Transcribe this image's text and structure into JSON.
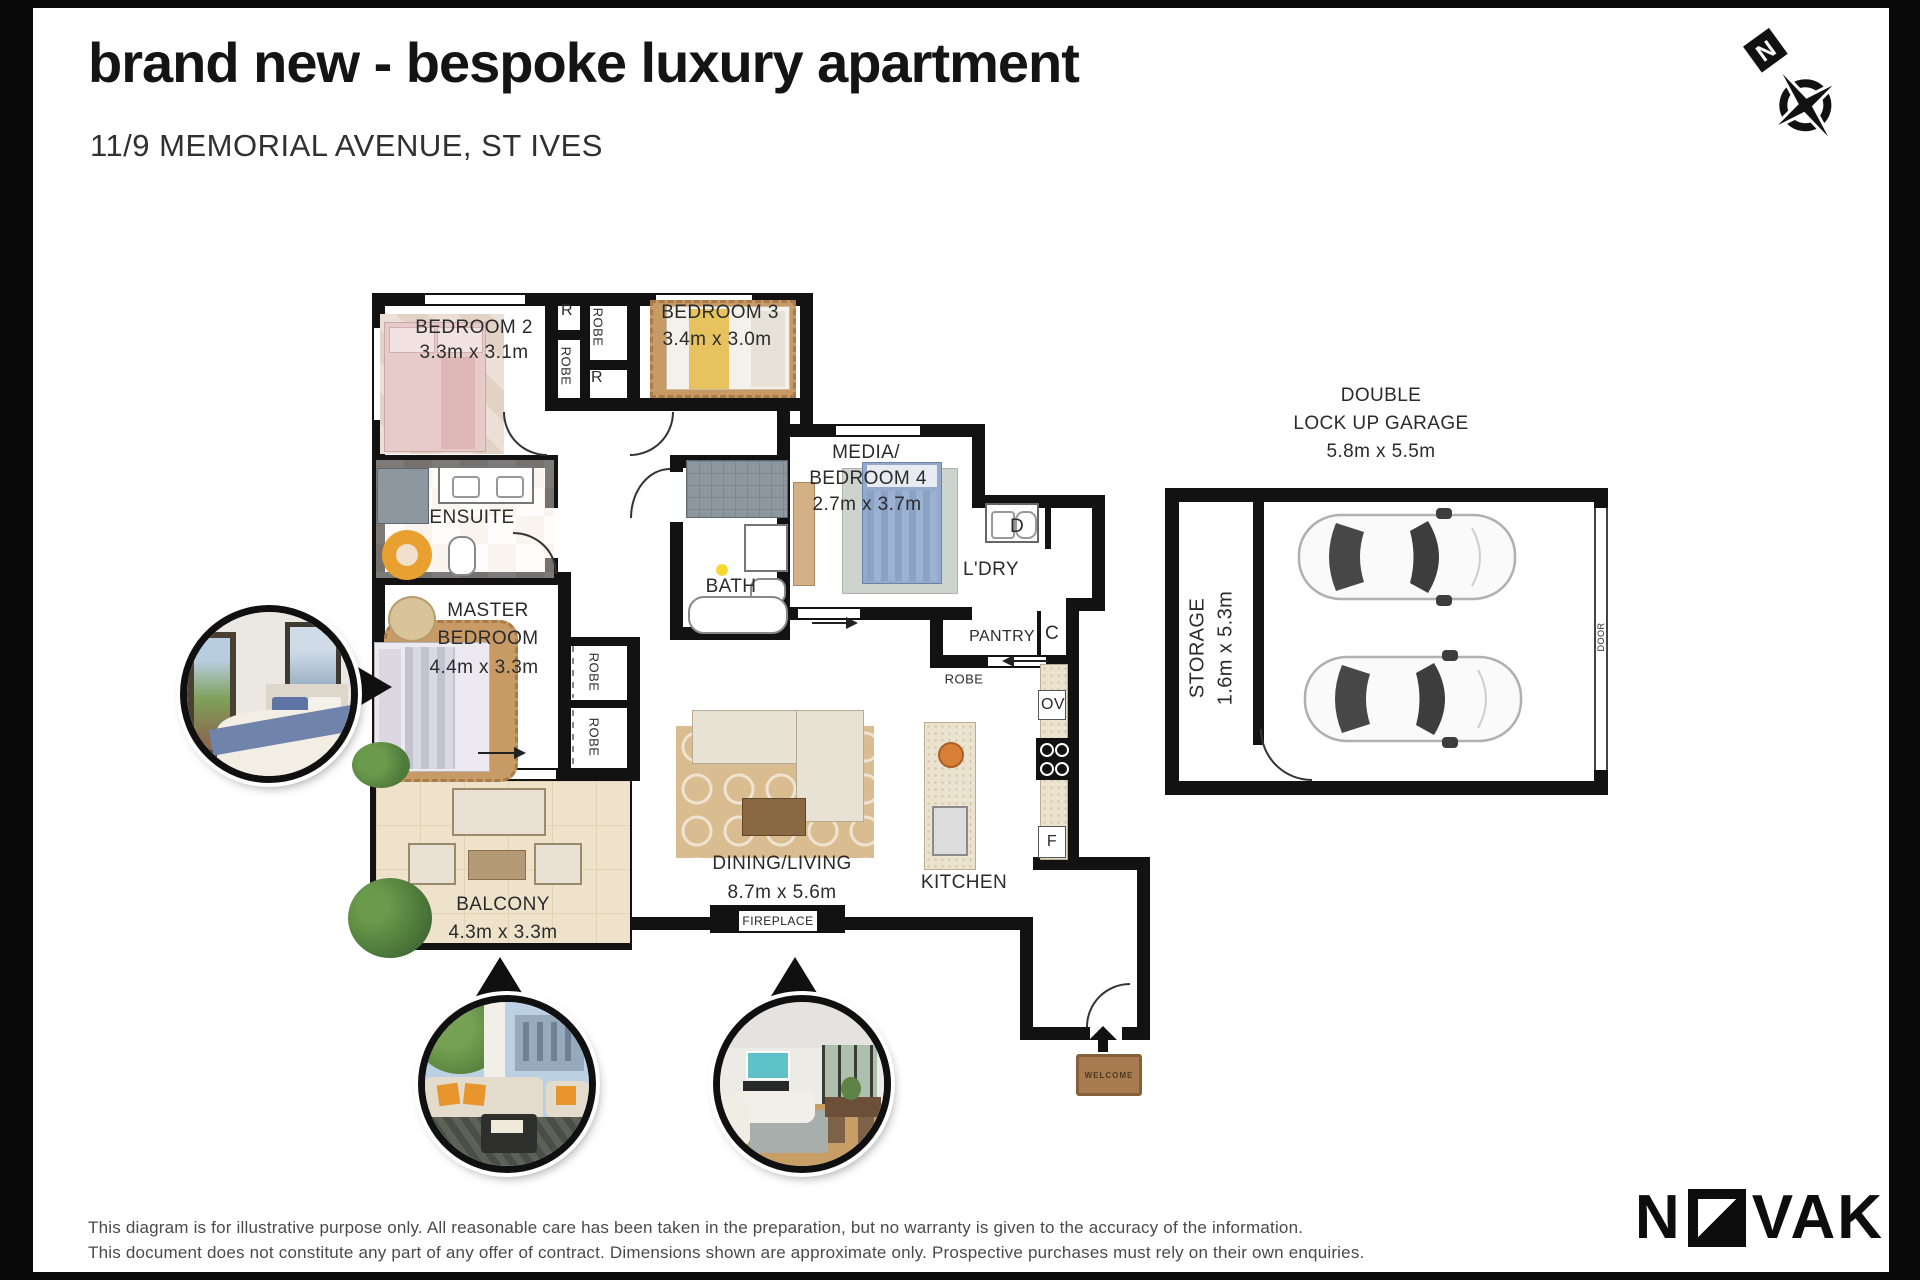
{
  "header": {
    "title": "brand new - bespoke luxury apartment",
    "subtitle": "11/9 MEMORIAL AVENUE, ST IVES"
  },
  "compass": {
    "north": "N"
  },
  "rooms": {
    "bedroom2": {
      "name": "BEDROOM 2",
      "dims": "3.3m x 3.1m"
    },
    "bedroom3": {
      "name": "BEDROOM 3",
      "dims": "3.4m x 3.0m"
    },
    "ensuite": {
      "name": "ENSUITE"
    },
    "master": {
      "line1": "MASTER",
      "line2": "BEDROOM",
      "dims": "4.4m x 3.3m"
    },
    "media": {
      "line1": "MEDIA/",
      "line2": "BEDROOM 4",
      "dims": "2.7m x 3.7m"
    },
    "bath": {
      "name": "BATH"
    },
    "laundry": {
      "name": "L'DRY"
    },
    "pantry": {
      "name": "PANTRY"
    },
    "dining": {
      "name": "DINING/LIVING",
      "dims": "8.7m x 5.6m"
    },
    "kitchen": {
      "name": "KITCHEN"
    },
    "balcony": {
      "name": "BALCONY",
      "dims": "4.3m x 3.3m"
    },
    "garage": {
      "line1": "DOUBLE",
      "line2": "LOCK UP GARAGE",
      "dims": "5.8m x 5.5m"
    },
    "storage": {
      "name": "STORAGE",
      "dims": "1.6m x 5.3m"
    }
  },
  "labels": {
    "robe": "ROBE",
    "r": "R",
    "dryer": "D",
    "cupboard": "C",
    "oven": "OV",
    "fridge": "F",
    "fireplace": "FIREPLACE",
    "door": "DOOR",
    "welcome": "WELCOME"
  },
  "footer": {
    "line1": "This diagram is for illustrative purpose only. All reasonable care has been taken in the preparation, but no warranty is given to the accuracy of the information.",
    "line2": "This document does not constitute any part of any offer of contract. Dimensions shown are approximate only. Prospective purchases must rely on their own enquiries."
  },
  "brand": {
    "prefix": "N",
    "suffix": "VAK"
  },
  "colors": {
    "wall": "#121212",
    "balcony_floor": "#efe2cb",
    "counter": "#ebe3cf",
    "rug_tan": "#c89a66",
    "bed_pink": "#e7cbcb",
    "bed_blue": "#93aacd",
    "mat_brown": "#a87c50"
  }
}
